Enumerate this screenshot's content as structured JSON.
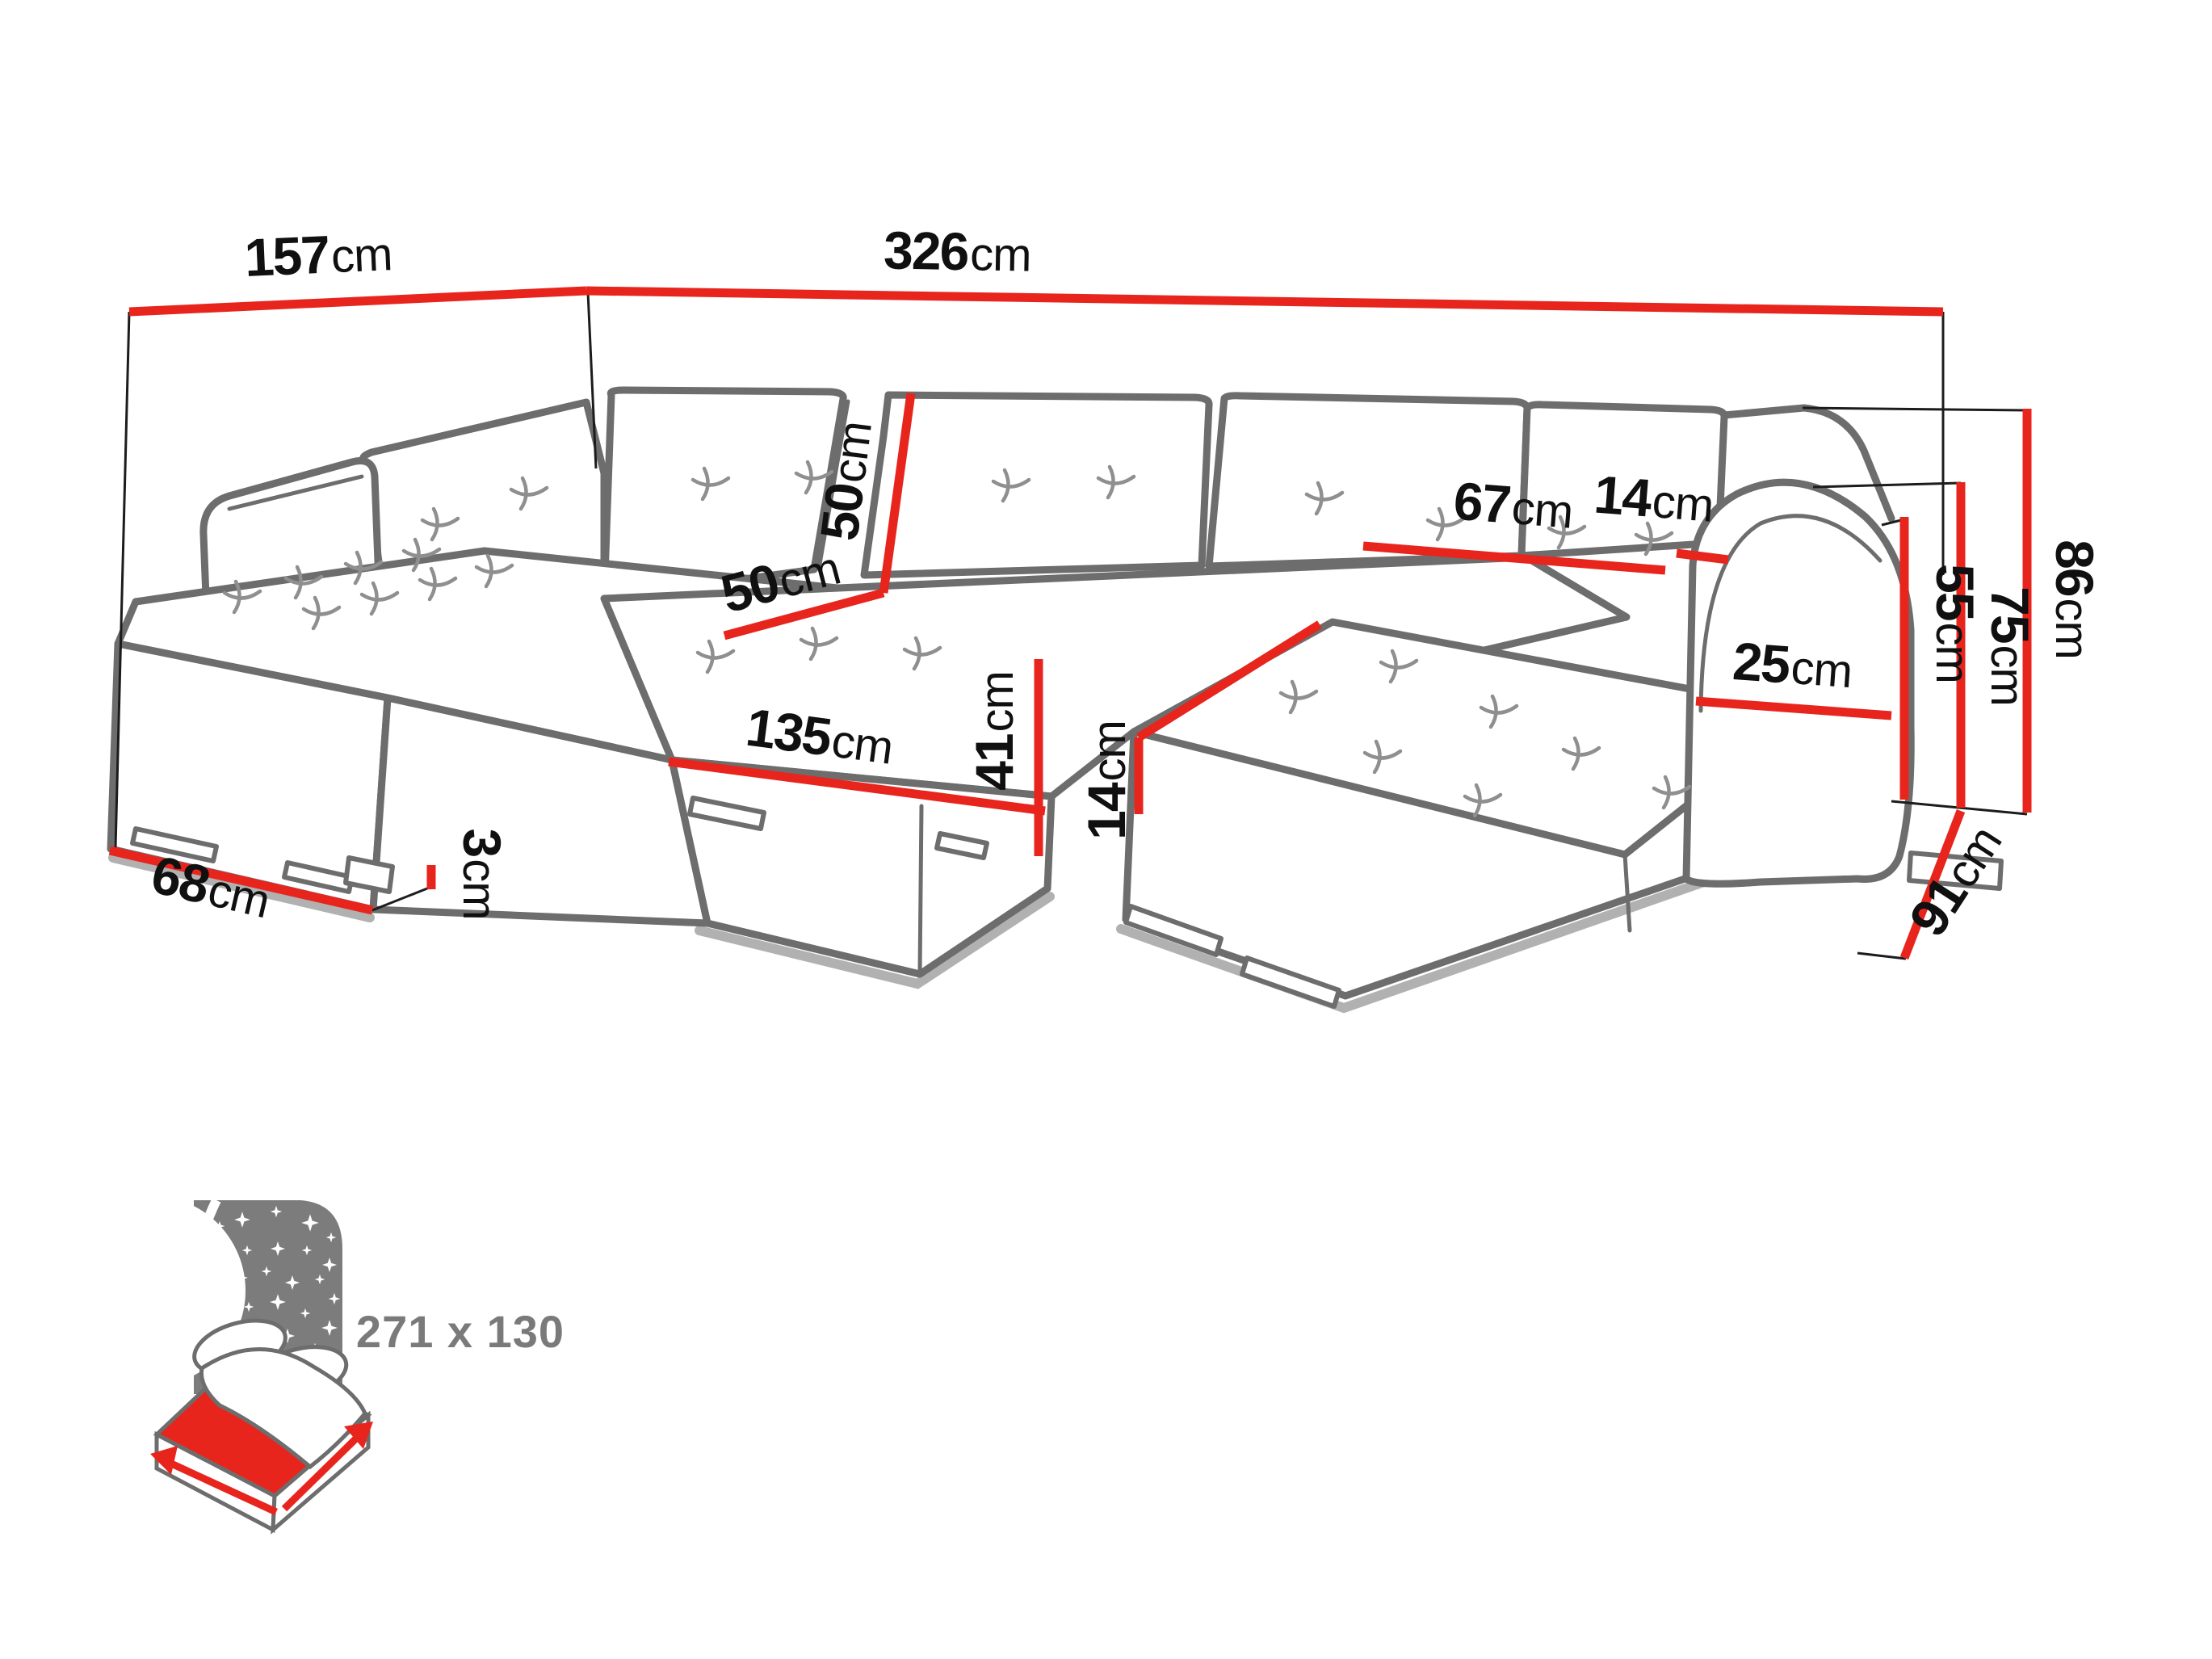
{
  "title": "corner-sofa-dimensions-diagram",
  "colors": {
    "dimension_red": "#e8251d",
    "sofa_line_gray": "#6d6d6d",
    "text_black": "#101010",
    "bed_icon_gray": "#7c7c7c",
    "bed_text_gray": "#7a7a7a"
  },
  "dimensions": {
    "top_left_width": {
      "value": "157",
      "unit": "cm"
    },
    "top_main_width": {
      "value": "326",
      "unit": "cm"
    },
    "backrest_cushion_width": {
      "value": "67",
      "unit": "cm"
    },
    "backrest_side_gap": {
      "value": "14",
      "unit": "cm"
    },
    "armrest_width": {
      "value": "25",
      "unit": "cm"
    },
    "backrest_height": {
      "value": "50",
      "unit": "cm"
    },
    "corner_seat_depth": {
      "value": "50",
      "unit": "cm"
    },
    "front_seat_width": {
      "value": "135",
      "unit": "cm"
    },
    "seat_height": {
      "value": "41",
      "unit": "cm"
    },
    "cushion_thickness": {
      "value": "14",
      "unit": "cm"
    },
    "armrest_front_height": {
      "value": "55",
      "unit": "cm"
    },
    "armrest_height": {
      "value": "75",
      "unit": "cm"
    },
    "total_height": {
      "value": "86",
      "unit": "cm"
    },
    "chaise_depth": {
      "value": "91",
      "unit": "cm"
    },
    "chaise_width": {
      "value": "68",
      "unit": "cm"
    },
    "leg_height": {
      "value": "3",
      "unit": "cm"
    }
  },
  "sleeping_area": {
    "size_label": "271 x 130"
  }
}
